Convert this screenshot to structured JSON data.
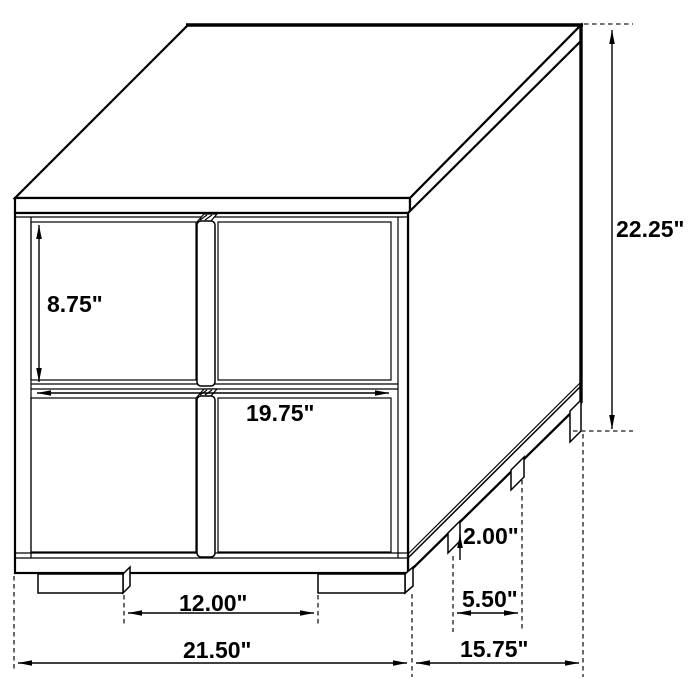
{
  "diagram": {
    "subject": "2-drawer nightstand isometric dimension drawing",
    "unit": "inches",
    "line_color": "#000000",
    "background_color": "#ffffff",
    "labels": {
      "drawer_height": "8.75\"",
      "drawer_width": "19.75\"",
      "overall_height": "22.25\"",
      "leg_height": "2.00\"",
      "side_leg_gap": "5.50\"",
      "front_leg_gap": "12.00\"",
      "overall_width": "21.50\"",
      "overall_depth": "15.75\""
    }
  }
}
